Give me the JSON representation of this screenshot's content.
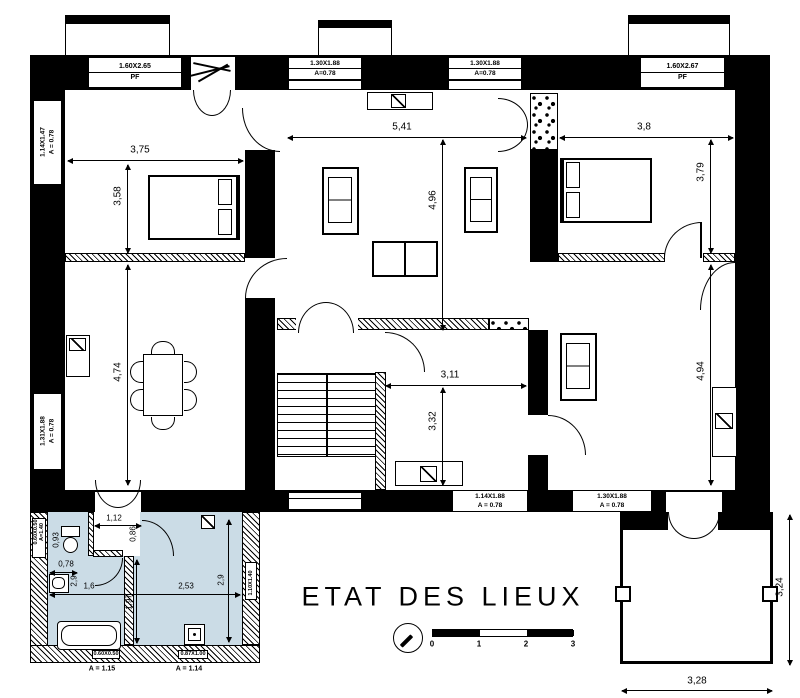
{
  "drawing": {
    "title": "ETAT DES LIEUX",
    "colors": {
      "line": "#000000",
      "bath_highlight": "#cbdce6"
    },
    "scale_bar": {
      "ticks": [
        "0",
        "1",
        "2",
        "3"
      ]
    },
    "windows": {
      "top_left": {
        "size": "1.60X2.65",
        "note": "PF"
      },
      "top_mid_left": {
        "size": "1.30X1.88",
        "note": "A=0.78"
      },
      "top_mid_right": {
        "size": "1.30X1.88",
        "note": "A=0.78"
      },
      "top_right": {
        "size": "1.60X2.67",
        "note": "PF"
      },
      "left_upper": {
        "size": "1.14X1.47",
        "note": "A = 0.78"
      },
      "left_lower": {
        "size": "1.31X1.88",
        "note": "A = 0.78"
      },
      "bottom_center": {
        "size": "1.14X1.88",
        "note": "A = 0.78"
      },
      "bottom_right": {
        "size": "1.30X1.88",
        "note": "A = 0.78"
      },
      "annex_left": {
        "size": "0.60X0.50",
        "note": "A=1.40"
      },
      "annex_bottom_left": {
        "size": "0.60X0.50",
        "note": "A = 1.15"
      },
      "annex_bottom_right": {
        "size": "0.87X1.00",
        "note": "A = 1.14"
      },
      "annex_right": {
        "size": "1.10X1.40",
        "note": ""
      }
    },
    "dimensions": {
      "bedroom1_width": "3,75",
      "bedroom1_height": "3,58",
      "living_width": "5,41",
      "living_height": "4,96",
      "bedroom2_width": "3,8",
      "bedroom2_height": "3,79",
      "dining_height": "4,74",
      "hall_width": "3,11",
      "hall_height": "3,32",
      "sitting_room_height": "4,94",
      "terrace_height": "3,24",
      "terrace_width": "3,28",
      "bath_entry_width": "1,12",
      "bath_entry_depth": "0,86",
      "bath_wc_height": "0,93",
      "bath_wc_width": "0,78",
      "bath_left_height": "2,9",
      "bath_left_width": "1,6",
      "bath_right_width": "2,53",
      "bath_right_height": "2,9",
      "bath_mid_height": "1,97"
    }
  }
}
